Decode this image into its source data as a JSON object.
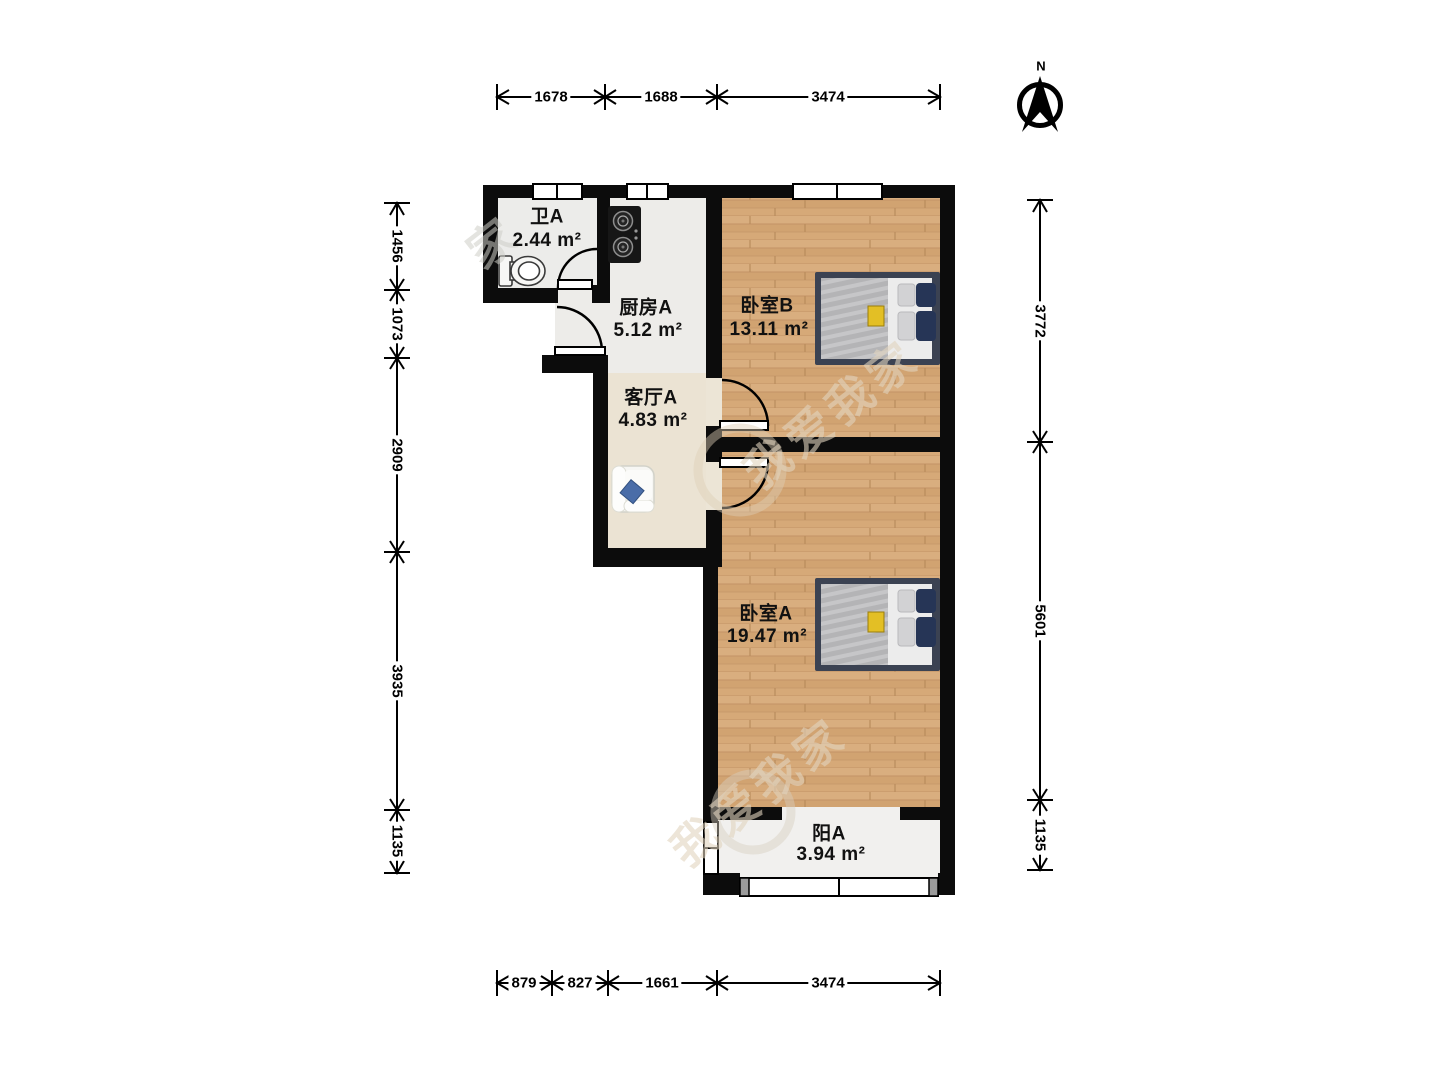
{
  "compass": {
    "label": "N"
  },
  "rooms": [
    {
      "id": "bathroom",
      "name": "卫A",
      "area": "2.44 m²"
    },
    {
      "id": "kitchen",
      "name": "厨房A",
      "area": "5.12 m²"
    },
    {
      "id": "living",
      "name": "客厅A",
      "area": "4.83 m²"
    },
    {
      "id": "bedroom-b",
      "name": "卧室B",
      "area": "13.11 m²"
    },
    {
      "id": "bedroom-a",
      "name": "卧室A",
      "area": "19.47 m²"
    },
    {
      "id": "balcony",
      "name": "阳A",
      "area": "3.94 m²"
    }
  ],
  "dimensions": {
    "top": [
      "1678",
      "1688",
      "3474"
    ],
    "bottom": [
      "879",
      "827",
      "1661",
      "3474"
    ],
    "left": [
      "1456",
      "1073",
      "2909",
      "3935",
      "1135"
    ],
    "right": [
      "3772",
      "5601",
      "1135"
    ]
  },
  "watermark": {
    "text": "我爱我家",
    "text_short": "家"
  },
  "colors": {
    "wall": "#0c0c0c",
    "wood_floor": "#d7ab7b",
    "living_floor": "#ebe3d3",
    "kitchen_floor": "#edece9",
    "bathroom_floor": "#ececea",
    "balcony_floor": "#f1f0ee",
    "bed_platform": "#3b4252",
    "pillow_navy": "#263556",
    "accent_yellow": "#e3bf25",
    "sofa_pillow_blue": "#4a6da8",
    "window_cap_gray": "#9b9b9b"
  }
}
